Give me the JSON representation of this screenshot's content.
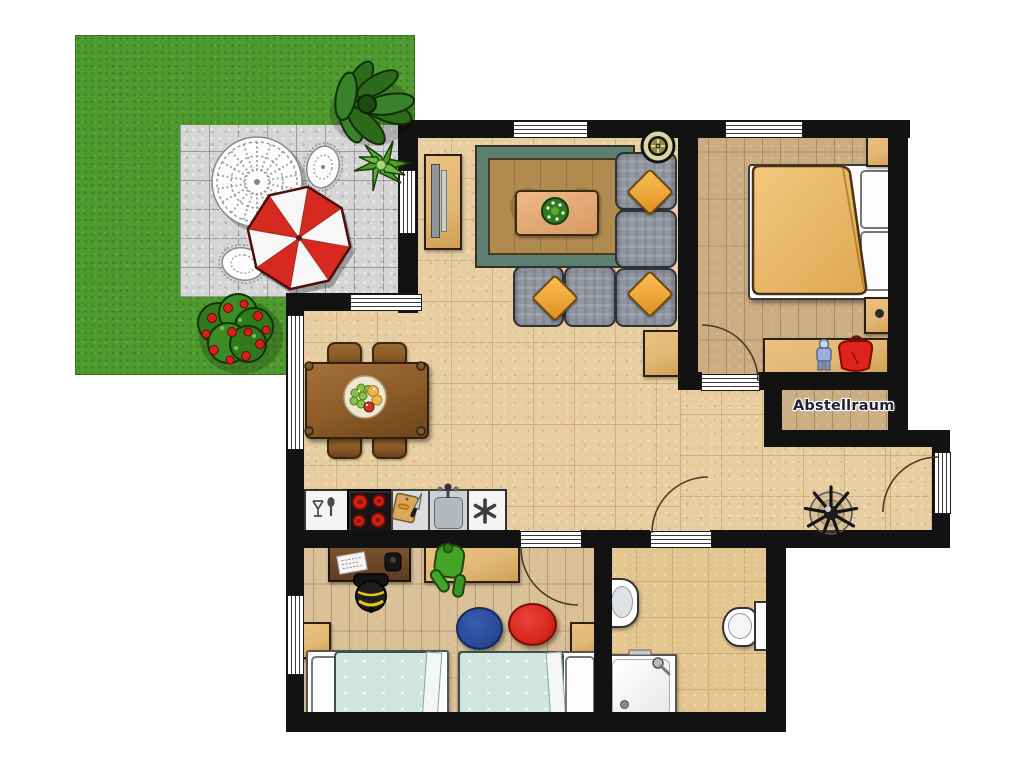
{
  "labels": {
    "storage_room": "Abstellraum"
  },
  "palette": {
    "wall": "#121212",
    "tile_floor": "#e7cd9f",
    "wood_floor": "#cbad83",
    "kids_floor": "#d9c096",
    "bath_floor": "#e3c58f",
    "grass": "#4e9a2e",
    "patio": "#d5d5d5",
    "rug_border": "#5d7f72",
    "rug_field": "#b18a50",
    "sofa_gray": "#9298a2",
    "pillow_orange": "#f0a93c",
    "umbrella_red": "#d62a20",
    "cabinet_wood": "#e2b877",
    "table_brown": "#8a5a28",
    "duvet_orange": "#e9ba6b",
    "kids_blanket": "#cfe6df",
    "round_rug_blue": "#2a4a9a",
    "round_rug_red": "#d8281e"
  }
}
